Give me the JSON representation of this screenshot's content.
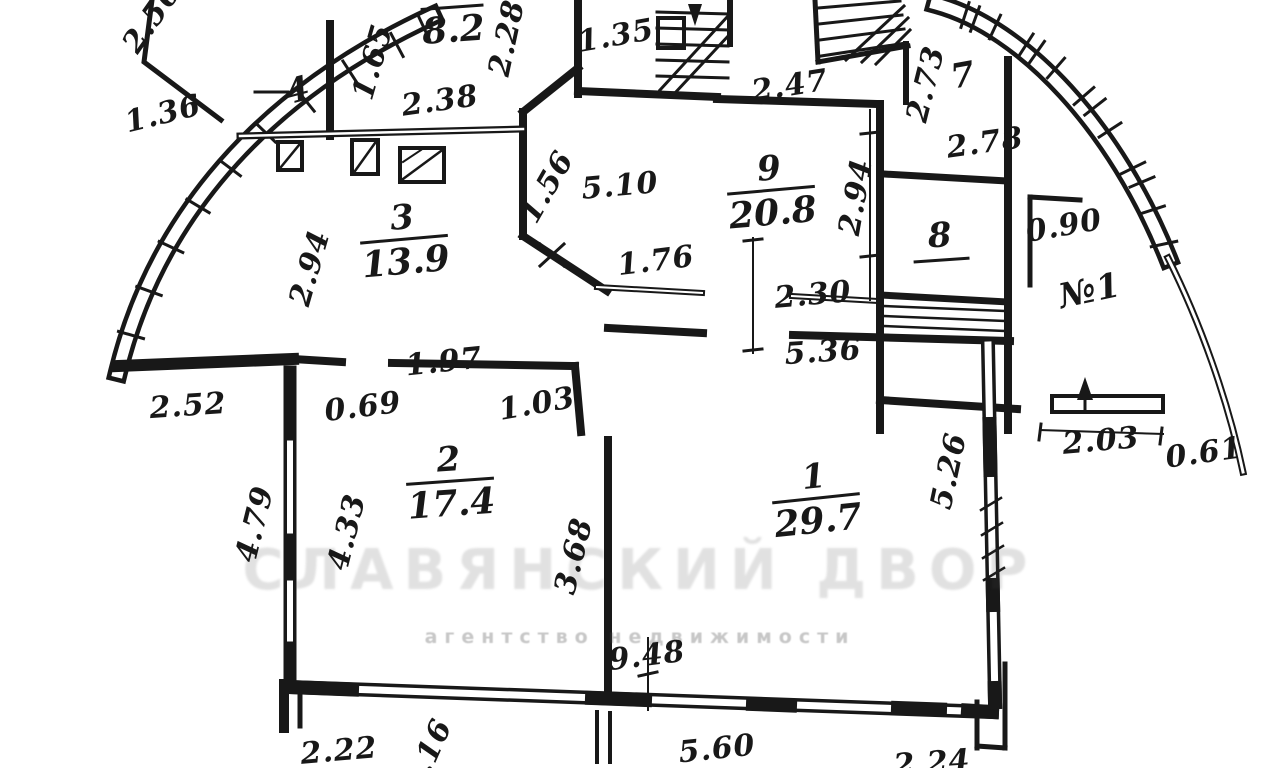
{
  "meta": {
    "type": "apartment-floor-plan-scan",
    "ink_color": "#181818",
    "paper_color": "#ffffff",
    "watermark_color": "#777777",
    "apartment_label": "№1"
  },
  "watermark": {
    "line1": "СЛАВЯНСКИЙ ДВОР",
    "line2": "агентство недвижимости"
  },
  "rooms": [
    {
      "number": "1",
      "area": "29.7",
      "x": 816,
      "y": 500,
      "style": "fraction",
      "rot": -6
    },
    {
      "number": "2",
      "area": "17.4",
      "x": 450,
      "y": 483,
      "style": "fraction",
      "rot": -4
    },
    {
      "number": "3",
      "area": "13.9",
      "x": 404,
      "y": 241,
      "style": "fraction",
      "rot": -5
    },
    {
      "number": "5",
      "area": "8.2",
      "x": 452,
      "y": 9,
      "style": "fraction",
      "rot": -4
    },
    {
      "number": "9",
      "area": "20.8",
      "x": 771,
      "y": 192,
      "style": "fraction",
      "rot": -5
    },
    {
      "number": "4",
      "x": 298,
      "y": 92,
      "style": "plain",
      "rot": -15
    },
    {
      "number": "7",
      "x": 963,
      "y": 77,
      "style": "plain",
      "rot": -10
    },
    {
      "number": "8",
      "x": 940,
      "y": 240,
      "style": "underline",
      "rot": -4
    }
  ],
  "dimensions": [
    {
      "value": "2.56",
      "x": 152,
      "y": 18,
      "rot": -55,
      "name": "dim-2-56"
    },
    {
      "value": "1.36",
      "x": 163,
      "y": 114,
      "rot": -14,
      "name": "dim-1-36"
    },
    {
      "value": "1.65",
      "x": 373,
      "y": 62,
      "rot": -74,
      "name": "dim-1-65"
    },
    {
      "value": "2.38",
      "x": 440,
      "y": 101,
      "rot": -8,
      "name": "dim-2-38"
    },
    {
      "value": "2.28",
      "x": 507,
      "y": 38,
      "rot": -78,
      "name": "dim-2-28"
    },
    {
      "value": "1.35",
      "x": 616,
      "y": 36,
      "rot": -10,
      "name": "dim-1-35"
    },
    {
      "value": "2.47",
      "x": 790,
      "y": 86,
      "rot": -9,
      "name": "dim-2-47"
    },
    {
      "value": "2.73",
      "x": 926,
      "y": 84,
      "rot": -76,
      "name": "dim-2-73"
    },
    {
      "value": "2.78",
      "x": 985,
      "y": 143,
      "rot": -8,
      "name": "dim-2-78"
    },
    {
      "value": "2.94",
      "x": 856,
      "y": 197,
      "rot": -80,
      "name": "dim-2-94-right"
    },
    {
      "value": "5.10",
      "x": 620,
      "y": 186,
      "rot": -5,
      "name": "dim-5-10"
    },
    {
      "value": "1.56",
      "x": 547,
      "y": 187,
      "rot": -60,
      "name": "dim-1-56"
    },
    {
      "value": "2.94",
      "x": 310,
      "y": 268,
      "rot": -74,
      "name": "dim-2-94-left"
    },
    {
      "value": "1.76",
      "x": 656,
      "y": 261,
      "rot": -7,
      "name": "dim-1-76"
    },
    {
      "value": "2.30",
      "x": 813,
      "y": 295,
      "rot": -5,
      "name": "dim-2-30"
    },
    {
      "value": "5.36",
      "x": 823,
      "y": 352,
      "rot": -4,
      "name": "dim-5-36"
    },
    {
      "value": "0.90",
      "x": 1064,
      "y": 226,
      "rot": -10,
      "name": "dim-0-90"
    },
    {
      "value": "№1",
      "x": 1090,
      "y": 291,
      "rot": -12,
      "size": 34,
      "name": "apartment-number-label"
    },
    {
      "value": "1.97",
      "x": 444,
      "y": 362,
      "rot": -6,
      "name": "dim-1-97"
    },
    {
      "value": "2.52",
      "x": 188,
      "y": 406,
      "rot": -4,
      "name": "dim-2-52"
    },
    {
      "value": "0.69",
      "x": 363,
      "y": 407,
      "rot": -7,
      "name": "dim-0-69"
    },
    {
      "value": "1.03",
      "x": 537,
      "y": 404,
      "rot": -10,
      "name": "dim-1-03"
    },
    {
      "value": "2.03",
      "x": 1101,
      "y": 441,
      "rot": -5,
      "name": "dim-2-03"
    },
    {
      "value": "0.61",
      "x": 1204,
      "y": 453,
      "rot": -8,
      "name": "dim-0-61"
    },
    {
      "value": "5.26",
      "x": 949,
      "y": 471,
      "rot": -78,
      "name": "dim-5-26"
    },
    {
      "value": "4.79",
      "x": 255,
      "y": 524,
      "rot": -76,
      "name": "dim-4-79"
    },
    {
      "value": "4.33",
      "x": 347,
      "y": 532,
      "rot": -76,
      "name": "dim-4-33"
    },
    {
      "value": "3.68",
      "x": 574,
      "y": 556,
      "rot": -76,
      "name": "dim-3-68"
    },
    {
      "value": "9.48",
      "x": 647,
      "y": 656,
      "rot": -7,
      "name": "dim-9-48"
    },
    {
      "value": "2.22",
      "x": 339,
      "y": 751,
      "rot": -5,
      "name": "dim-2-22"
    },
    {
      "value": "1.16",
      "x": 428,
      "y": 756,
      "rot": -66,
      "name": "dim-1-16"
    },
    {
      "value": "5.60",
      "x": 717,
      "y": 749,
      "rot": -6,
      "name": "dim-5-60"
    },
    {
      "value": "2.24",
      "x": 932,
      "y": 763,
      "rot": -4,
      "name": "dim-2-24"
    }
  ]
}
